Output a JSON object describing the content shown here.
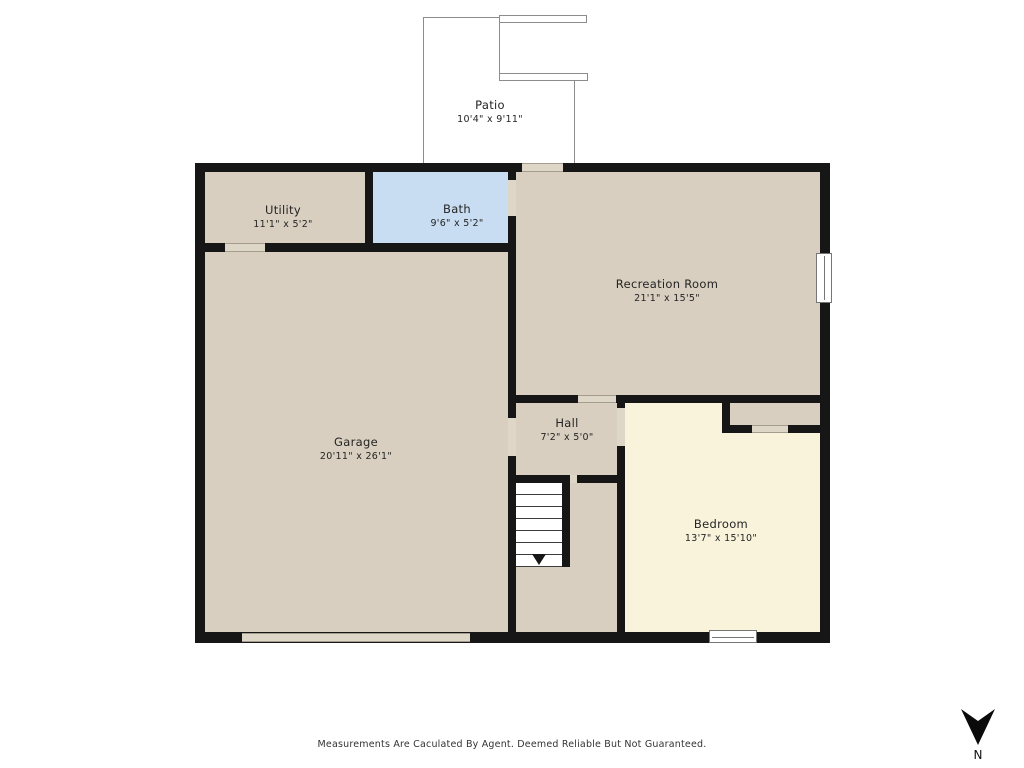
{
  "plan": {
    "rooms": [
      {
        "id": "patio",
        "name": "Patio",
        "dims": "10'4\" x 9'11\""
      },
      {
        "id": "utility",
        "name": "Utility",
        "dims": "11'1\" x 5'2\""
      },
      {
        "id": "bath",
        "name": "Bath",
        "dims": "9'6\" x 5'2\""
      },
      {
        "id": "recreation-room",
        "name": "Recreation Room",
        "dims": "21'1\" x 15'5\""
      },
      {
        "id": "garage",
        "name": "Garage",
        "dims": "20'11\" x 26'1\""
      },
      {
        "id": "hall",
        "name": "Hall",
        "dims": "7'2\" x 5'0\""
      },
      {
        "id": "bedroom",
        "name": "Bedroom",
        "dims": "13'7\" x 15'10\""
      }
    ],
    "features": [
      "stairs-down",
      "closet",
      "garage-door",
      "window-right-wall",
      "window-bedroom",
      "patio-steps"
    ],
    "colors": {
      "wall": "#161616",
      "room_fill": "#d8cfc0",
      "bath_fill": "#c9ddf2",
      "bedroom_fill": "#faf3dc",
      "background": "#ffffff"
    }
  },
  "footer": {
    "disclaimer": "Measurements Are Caculated By Agent. Deemed Reliable But Not Guaranteed."
  },
  "compass": {
    "label": "N",
    "direction": "down"
  }
}
